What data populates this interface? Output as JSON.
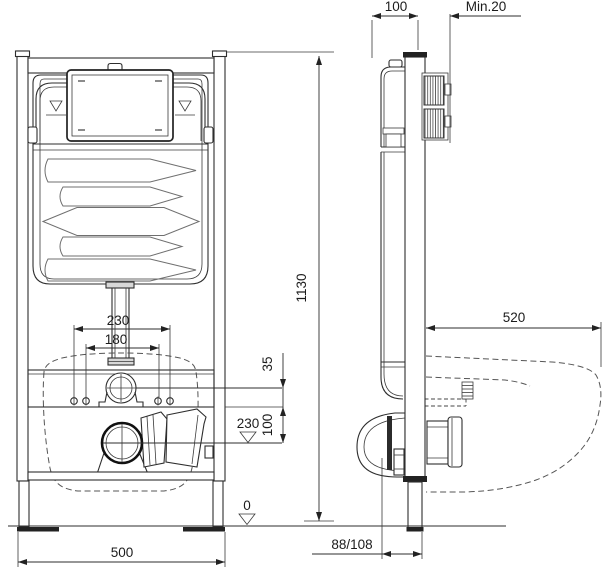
{
  "colors": {
    "line": "#2e2e2e",
    "bold": "#111111",
    "light_fill": "#d8d8d8",
    "background": "#ffffff"
  },
  "dims": {
    "side_frame_depth": "100",
    "side_wall_min": "Min.20",
    "frame_height": "1130",
    "bolt_spacing_outer": "230",
    "bolt_spacing_inner": "180",
    "inlet_offset": "35",
    "drain_level": "230",
    "inlet_drain_gap": "100",
    "floor_level": "0",
    "frame_width": "500",
    "bowl_depth": "520",
    "outlet_offset": "88/108"
  }
}
